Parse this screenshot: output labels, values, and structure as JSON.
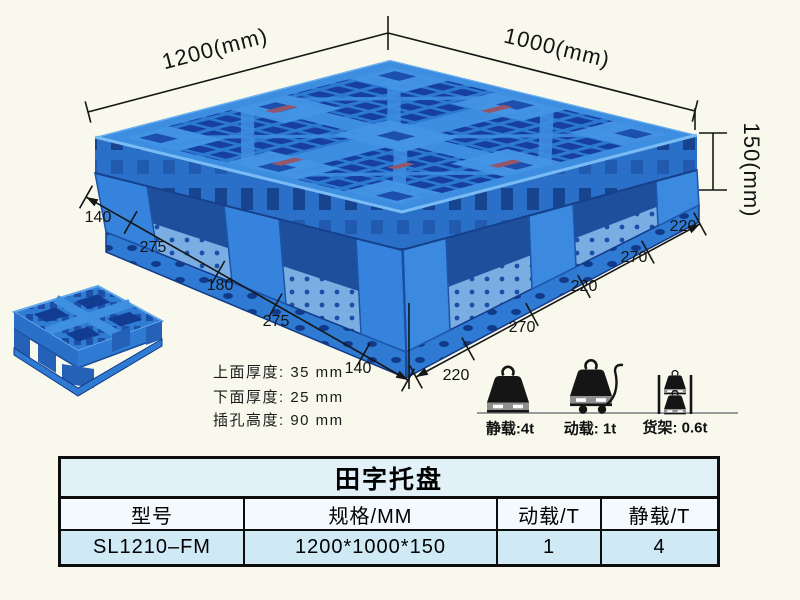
{
  "drawing": {
    "dim_length": "1200(mm)",
    "dim_width": "1000(mm)",
    "dim_height": "150(mm)",
    "left_chain": [
      "140",
      "275",
      "180",
      "275",
      "140"
    ],
    "right_chain": [
      "220",
      "270",
      "220",
      "270",
      "220"
    ]
  },
  "specs": [
    "上面厚度: 35 mm",
    "下面厚度: 25 mm",
    "插孔高度: 90 mm"
  ],
  "loads": [
    {
      "icon": "weight-on-ground-icon",
      "label": "静载:4t"
    },
    {
      "icon": "weight-on-trolley-icon",
      "label": "动载: 1t"
    },
    {
      "icon": "weights-on-rack-icon",
      "label": "货架: 0.6t"
    }
  ],
  "table": {
    "title": "田字托盘",
    "headers": [
      "型号",
      "规格/MM",
      "动载/T",
      "静载/T"
    ],
    "rows": [
      [
        "SL1210–FM",
        "1200*1000*150",
        "1",
        "4"
      ]
    ]
  },
  "colors": {
    "pallet_blue": "#2e7cd6",
    "pallet_hole_dark": "#173f9f",
    "pallet_highlight": "#3d8de0",
    "table_row_blue": "#cfe9f5",
    "background": "#f8f8ec"
  }
}
